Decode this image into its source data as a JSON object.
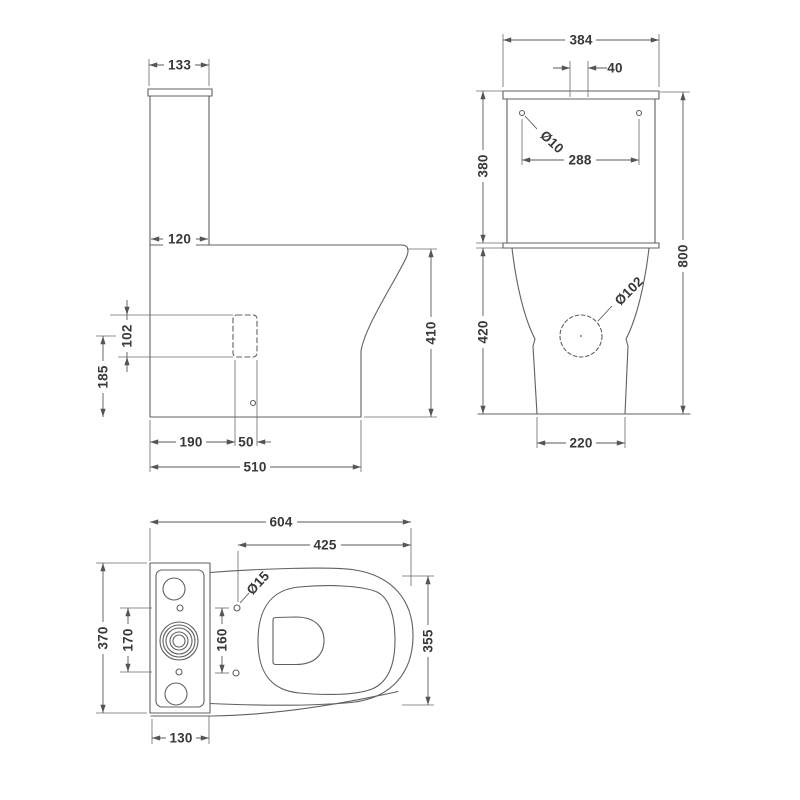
{
  "colors": {
    "outline": "#606060",
    "dimension_line": "#585858",
    "label_text": "#383838",
    "background": "#ffffff"
  },
  "views": {
    "side": {
      "dims": {
        "cistern_top_width": "133",
        "cistern_bottom_depth": "120",
        "outlet_diameter": "102",
        "outlet_centre_height": "185",
        "pan_height": "410",
        "front_to_outlet": "190",
        "outlet_width": "50",
        "overall_depth": "510"
      }
    },
    "front": {
      "dims": {
        "cistern_width": "384",
        "button_offset": "40",
        "fixing_hole_diameter": "Ø10",
        "fixing_hole_centres": "288",
        "cistern_height": "380",
        "pan_height": "420",
        "overall_height": "800",
        "outlet_diameter": "Ø102",
        "pedestal_width": "220"
      }
    },
    "plan": {
      "dims": {
        "overall_projection": "604",
        "seat_projection": "425",
        "hinge_hole_diameter": "Ø15",
        "cistern_width": "370",
        "cistern_hole_centres": "170",
        "hinge_hole_centres": "160",
        "pan_width": "355",
        "cistern_depth": "130"
      }
    }
  }
}
